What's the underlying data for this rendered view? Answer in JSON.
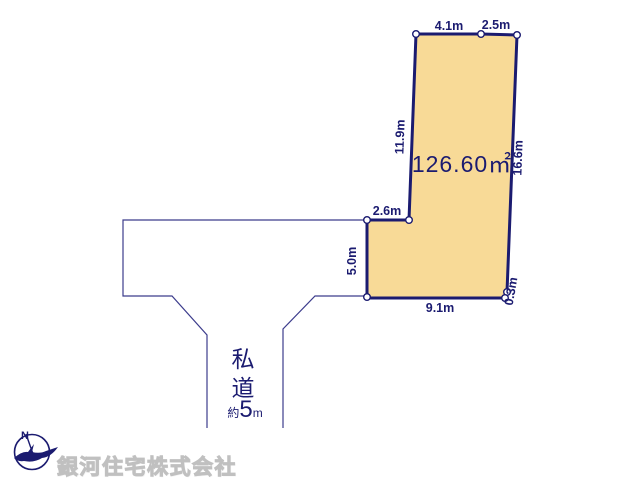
{
  "plot": {
    "area_label": "126.60㎡",
    "fill_color": "#f8da97",
    "outline_color": "#1b1b70",
    "dimensions": [
      {
        "edge": "top-left-segment",
        "label": "4.1m"
      },
      {
        "edge": "top-right-segment",
        "label": "2.5m"
      },
      {
        "edge": "upper-left-side",
        "label": "11.9m"
      },
      {
        "edge": "right-side",
        "label": "16.6m"
      },
      {
        "edge": "setback-top-segment",
        "label": "2.6m"
      },
      {
        "edge": "lower-left-side",
        "label": "5.0m"
      },
      {
        "edge": "bottom-side",
        "label": "9.1m"
      },
      {
        "edge": "bottom-right-corner",
        "label": "0.3m"
      }
    ]
  },
  "road": {
    "type_label": "私道",
    "width_prefix": "約",
    "width_value": "5",
    "width_unit": "m"
  },
  "compass": {
    "north_label": "N"
  },
  "footer": {
    "company_name": "銀河住宅株式会社"
  }
}
